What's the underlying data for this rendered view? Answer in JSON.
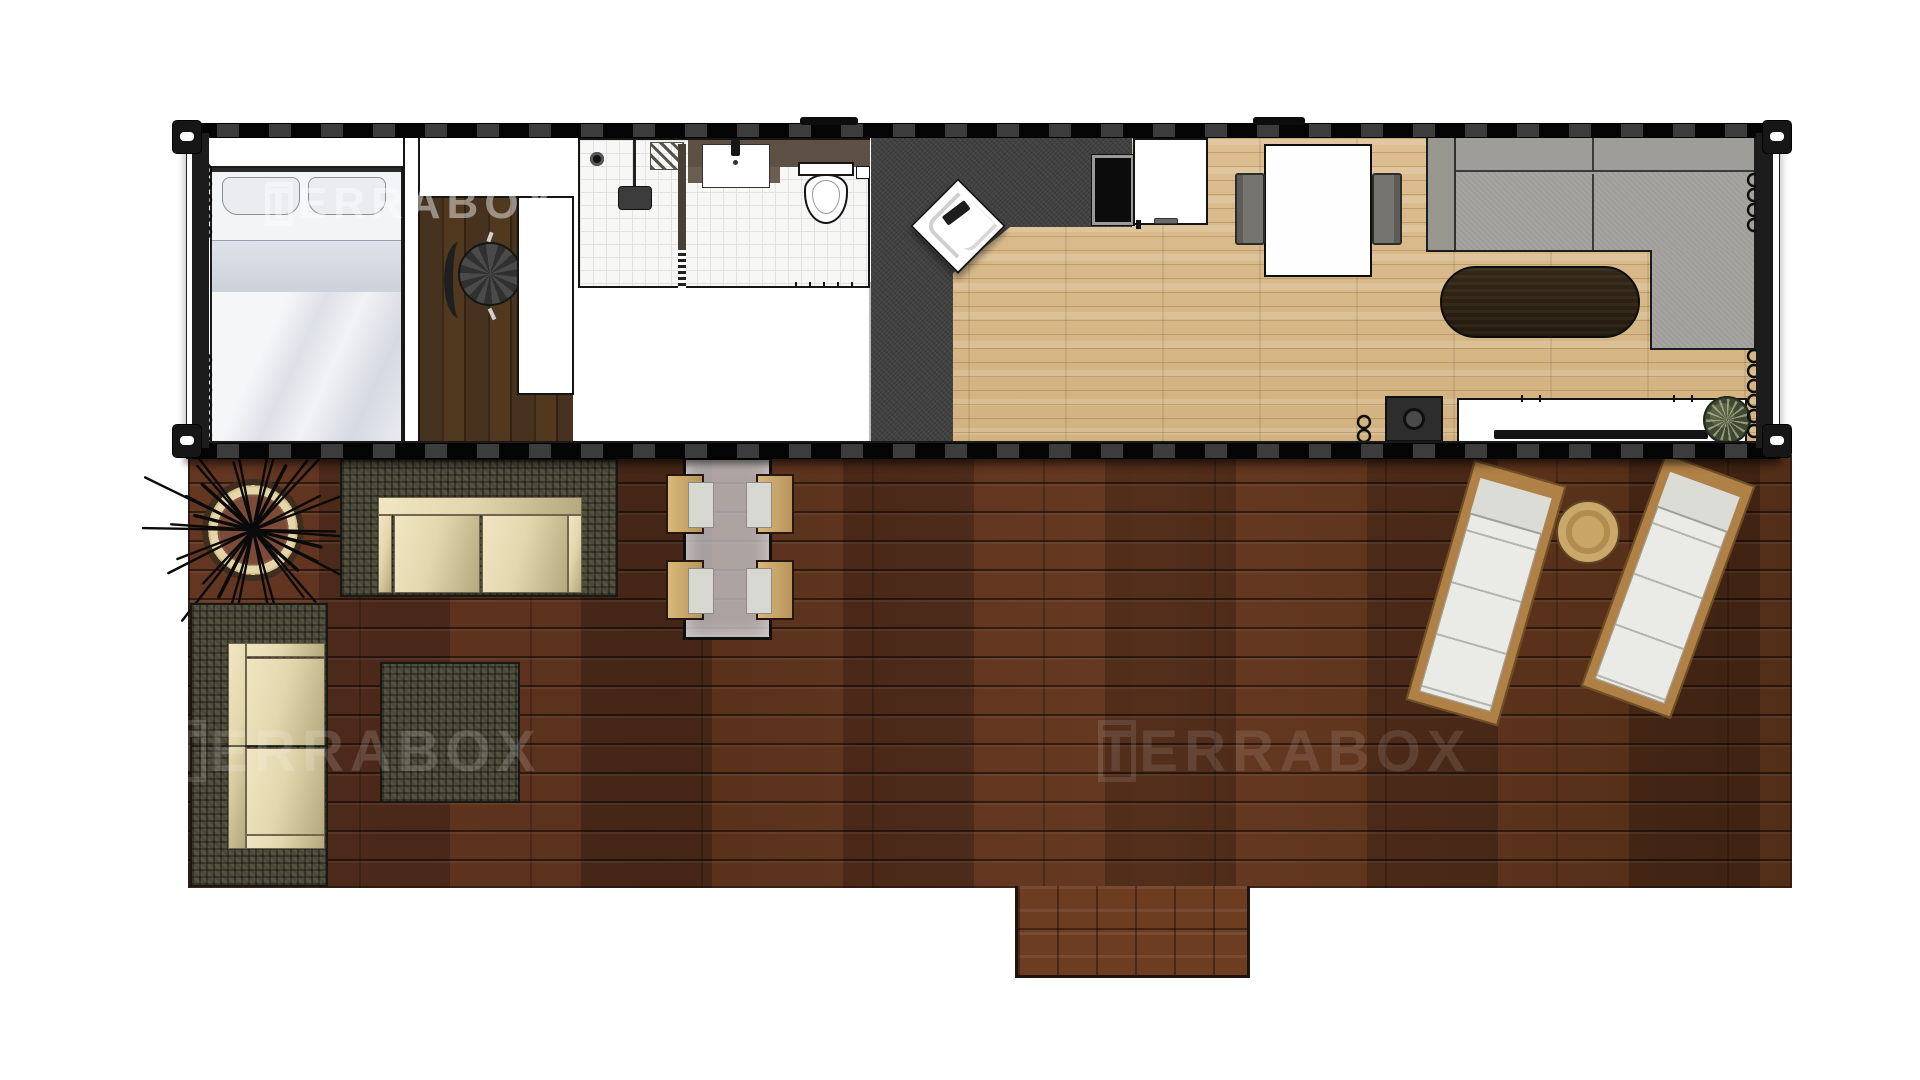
{
  "meta": {
    "title": "Container home floor plan - top view"
  },
  "watermark": {
    "text": "TERRABOX"
  },
  "colors": {
    "deck_base": "#53301c",
    "step": "#6d3d22",
    "oak_floor": "#d9bb8c",
    "walnut_floor": "#43301f",
    "charcoal": "#414141",
    "sofa_gray": "#a6a5a2",
    "wicker": "#4b4938",
    "cushion": "#e3d7ae",
    "lounger_frame": "#b08147",
    "lounger_pad": "#eaeae6",
    "glass_table": "#cbcbd0",
    "coffee_table": "#2b2115",
    "fire_ring_sand": "#e4d6a8",
    "fire_coals": "#7c4a38",
    "frame_black": "#141414",
    "watermark": "#ffffff"
  },
  "legend": {
    "container_rooms": [
      "bedroom",
      "closet-office",
      "bathroom",
      "entry-kitchen",
      "dining",
      "living-room"
    ],
    "container_items": [
      "bed",
      "pillows",
      "curtain-coils",
      "office-chair",
      "desk-unit",
      "shower-head",
      "shower-drain",
      "shower-glass",
      "vanity-sink",
      "toilet",
      "toilet-paper-holder",
      "corner-sink-unit",
      "black-appliance",
      "kitchen-counter",
      "dining-table",
      "dining-chairs",
      "sectional-sofa",
      "oval-coffee-table",
      "speaker",
      "tv-console",
      "tv",
      "potted-plant"
    ],
    "deck_items": [
      "fire-pit",
      "outdoor-sofa-top",
      "outdoor-sofa-left",
      "wicker-ottoman",
      "glass-dining-table",
      "deck-chairs",
      "sun-lounger-left",
      "sun-lounger-right",
      "round-side-table",
      "deck-step"
    ]
  }
}
